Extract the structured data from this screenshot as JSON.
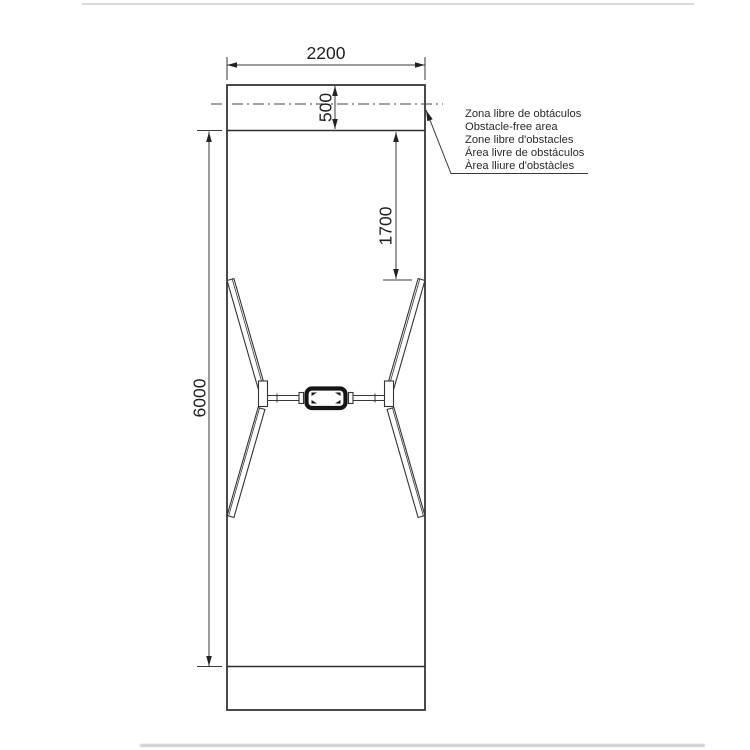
{
  "drawing": {
    "dimensions": {
      "overall_width": "2200",
      "end_clearance": "500",
      "beam_offset": "1700",
      "overall_length": "6000"
    },
    "legend": {
      "lines": [
        "Zona libre de obtáculos",
        "Obstacle-free area",
        "Zone libre d'obstacles",
        "Área livre de obstáculos",
        "Àrea lliure d'obstàcles"
      ]
    },
    "colors": {
      "line": "#333333",
      "text": "#222222",
      "sleeve_fill": "#151515",
      "page_artifact": "#d9d9d9"
    }
  }
}
